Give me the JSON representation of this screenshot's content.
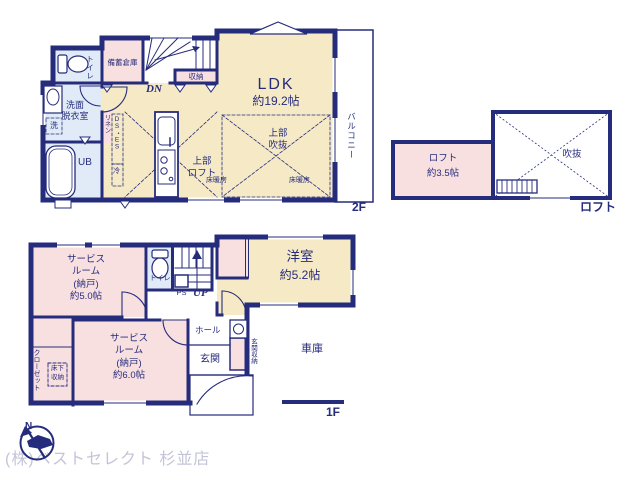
{
  "colors": {
    "wall": "#262c7c",
    "ldk_tan": "#f6eac6",
    "pink": "#f9e0e0",
    "wet_blue": "#e0ebf7",
    "logo_gray": "#c4c4d8"
  },
  "floor2": {
    "ldk_name": "LDK",
    "ldk_size": "約19.2帖",
    "toilet": "トイレ",
    "storage": "備蓄倉庫",
    "closet": "収納",
    "dn": "DN",
    "washroom_l1": "洗面",
    "washroom_l2": "脱衣室",
    "washer": "洗",
    "linen": "リネン",
    "duct": "DS・ES",
    "fridge": "冷",
    "bath": "UB",
    "void_l1": "上部",
    "void_l2": "吹抜",
    "loft_l1": "上部",
    "loft_l2": "ロフト",
    "floor_heating": "床暖房",
    "balcony": "バルコニー",
    "label": "2F"
  },
  "loft": {
    "name": "ロフト",
    "size": "約3.5帖",
    "void": "吹抜",
    "label": "ロフト"
  },
  "floor1": {
    "sr1_l1": "サービス",
    "sr1_l2": "ルーム",
    "sr1_l3": "(納戸)",
    "sr1_l4": "約5.0帖",
    "sr2_l1": "サービス",
    "sr2_l2": "ルーム",
    "sr2_l3": "(納戸)",
    "sr2_l4": "約6.0帖",
    "yoshitsu_name": "洋室",
    "yoshitsu_size": "約5.2帖",
    "toilet": "トイレ",
    "ps": "PS",
    "up": "UP",
    "hall": "ホール",
    "entrance": "玄関",
    "entrance_storage": "玄関収納",
    "garage": "車庫",
    "closet": "クローゼット",
    "underfloor_l1": "床下",
    "underfloor_l2": "収納",
    "label": "1F"
  },
  "footer": {
    "company": "(株)ベストセレクト 杉並店",
    "north": "N"
  }
}
